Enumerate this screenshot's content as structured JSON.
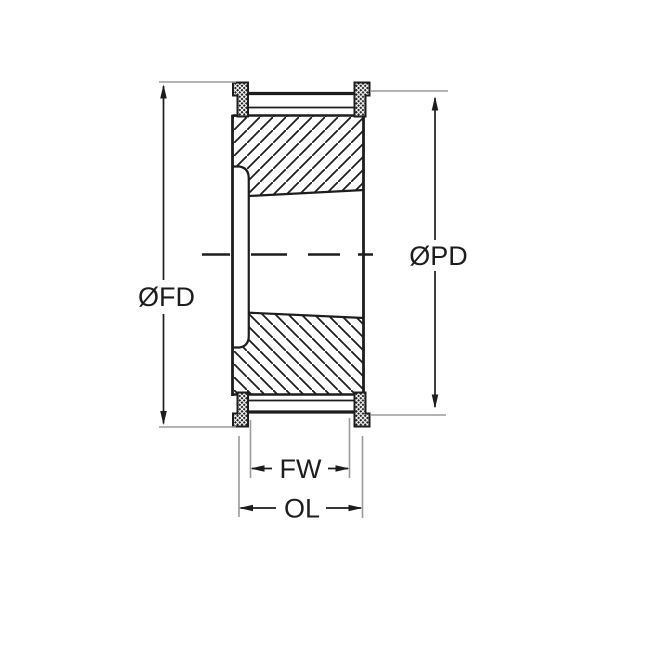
{
  "diagram": {
    "dim_labels": {
      "fd": "ØFD",
      "pd": "ØPD",
      "fw": "FW",
      "ol": "OL"
    },
    "colors": {
      "line": "#1d1d1f",
      "extension_line": "#9b9b9b",
      "background": "#ffffff"
    }
  }
}
